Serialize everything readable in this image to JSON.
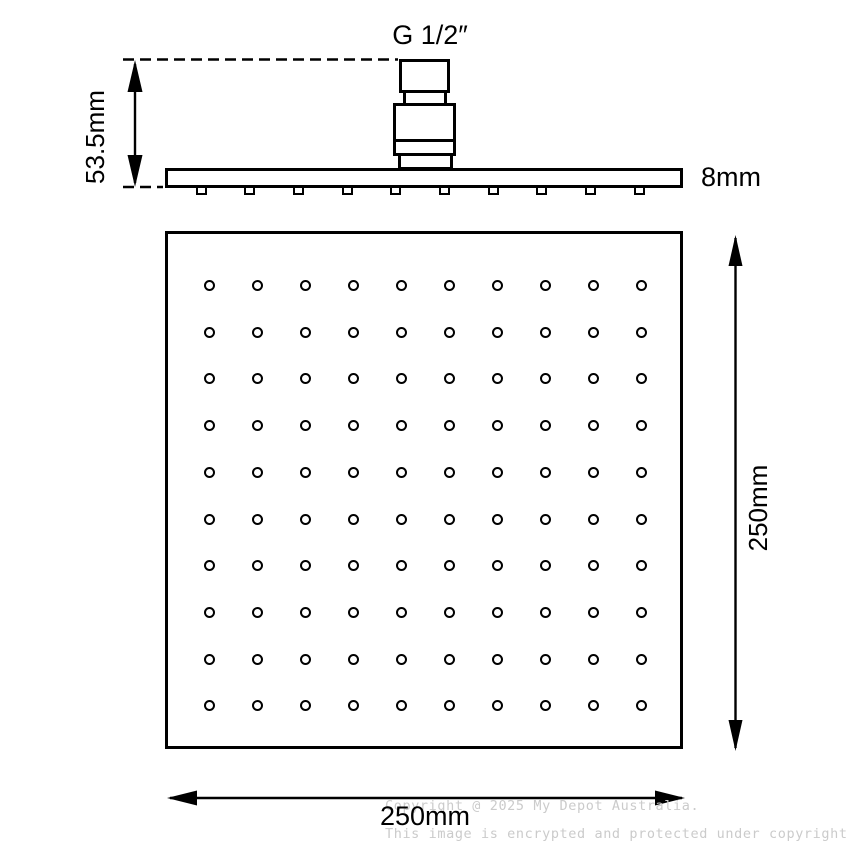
{
  "page": {
    "background": "#ffffff"
  },
  "colors": {
    "line": "#000000",
    "watermark": "#cbcbcb"
  },
  "side_view": {
    "connector_label": "G 1/2″",
    "height_dim_label": "53.5mm",
    "thickness_dim_label": "8mm",
    "nub_count": 10
  },
  "face_view": {
    "width_dim_label": "250mm",
    "height_dim_label": "250mm",
    "nozzle_grid": {
      "rows": 10,
      "cols": 10
    }
  },
  "watermark": {
    "line1": "Copyright @ 2025 My Depot Australia.",
    "line2": "This image is encrypted and protected under copyright law."
  }
}
